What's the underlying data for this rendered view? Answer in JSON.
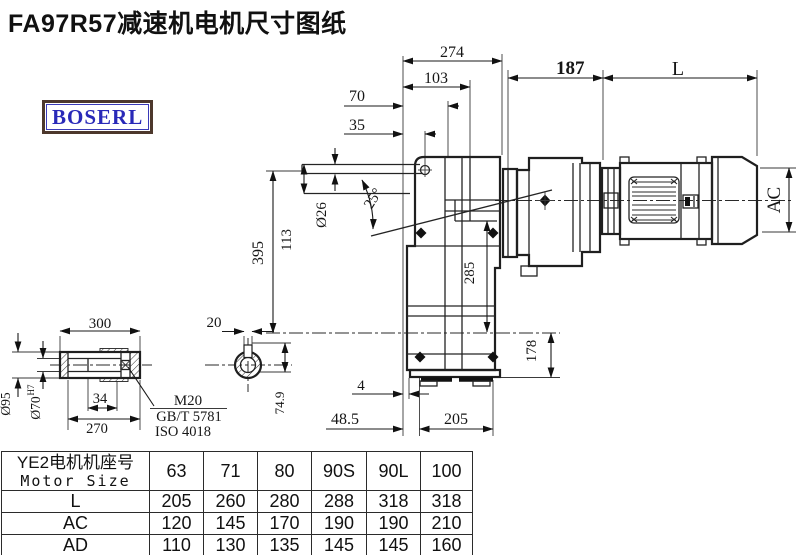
{
  "title": "FA97R57减速机电机尺寸图纸",
  "logo": "BOSERL",
  "colors": {
    "line": "#1f1f1f",
    "logo_text": "#2929b8",
    "logo_border": "#4d382c",
    "accent_blue": "#3a3ab8"
  },
  "dims": {
    "d274": "274",
    "d103": "103",
    "d70": "70",
    "d35": "35",
    "d187": "187",
    "dL": "L",
    "dAC": "AC",
    "d395": "395",
    "d113": "113",
    "d26": "Ø26",
    "d25": "25°",
    "d285": "285",
    "d178": "178",
    "d4": "4",
    "d48_5": "48.5",
    "d205": "205",
    "d300": "300",
    "d20": "20",
    "d95": "Ø95",
    "d70h7": "Ø70",
    "d70h7_sup": "H7",
    "d34": "34",
    "d270": "270",
    "d74_9": "74.9",
    "m20": "M20",
    "gbt": "GB/T 5781",
    "iso": "ISO 4018"
  },
  "table": {
    "header": {
      "line1": "YE2电机机座号",
      "line2": "Motor Size",
      "sizes": [
        "63",
        "71",
        "80",
        "90S",
        "90L",
        "100"
      ]
    },
    "rows": [
      {
        "label": "L",
        "values": [
          "205",
          "260",
          "280",
          "288",
          "318",
          "318"
        ]
      },
      {
        "label": "AC",
        "values": [
          "120",
          "145",
          "170",
          "190",
          "190",
          "210"
        ]
      },
      {
        "label": "AD",
        "values": [
          "110",
          "130",
          "135",
          "145",
          "145",
          "160"
        ]
      }
    ]
  }
}
